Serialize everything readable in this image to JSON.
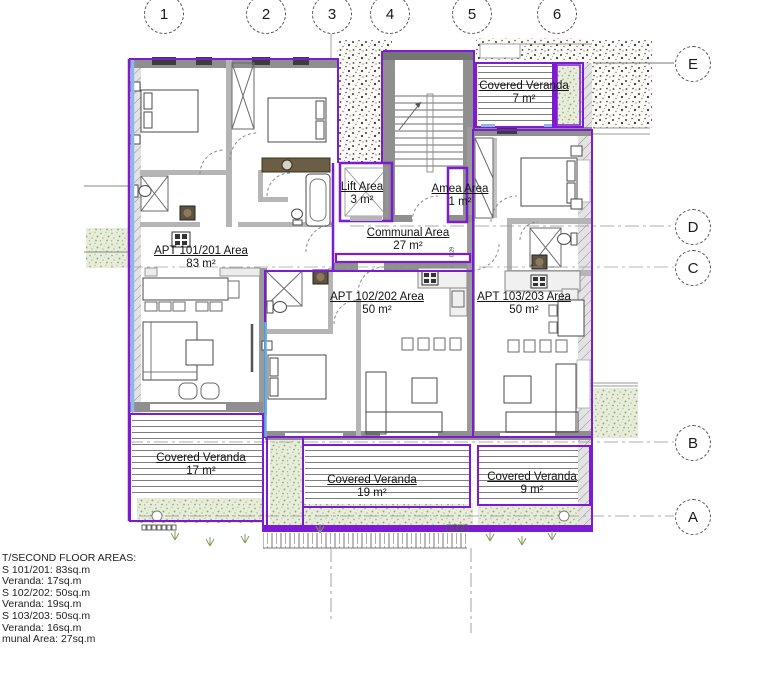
{
  "drawing": {
    "grid_columns": [
      "1",
      "2",
      "3",
      "4",
      "5",
      "6"
    ],
    "grid_rows": [
      "E",
      "D",
      "C",
      "B",
      "A"
    ]
  },
  "areas": {
    "apt101": {
      "name": "APT 101/201 Area",
      "value": "83 m²"
    },
    "apt102": {
      "name": "APT 102/202 Area",
      "value": "50 m²"
    },
    "apt103": {
      "name": "APT 103/203 Area",
      "value": "50 m²"
    },
    "communal": {
      "name": "Communal Area",
      "value": "27 m²"
    },
    "lift": {
      "name": "Lift Area",
      "value": "3 m²"
    },
    "amea": {
      "name": "Amea Area",
      "value": "1 m²"
    },
    "veranda_top": {
      "name": "Covered Veranda",
      "value": "7 m²"
    },
    "veranda_left": {
      "name": "Covered Veranda",
      "value": "17 m²"
    },
    "veranda_middle": {
      "name": "Covered Veranda",
      "value": "19 m²"
    },
    "veranda_right": {
      "name": "Covered Veranda",
      "value": "9 m²"
    }
  },
  "dimension": "0.29",
  "notes": {
    "lines": [
      "T/SECOND FLOOR AREAS:",
      "S 101/201: 83sq.m",
      "Veranda: 17sq.m",
      "S 102/202: 50sq.m",
      "Veranda: 19sq.m",
      "S 103/203: 50sq.m",
      "Veranda: 16sq.m",
      "munal Area: 27sq.m"
    ]
  },
  "colors": {
    "area_outline": "#7d1bd3",
    "glazing_blue": "#8cb8e8",
    "planting_green": "#9cb57e",
    "wall_gray": "#8f8f8f"
  }
}
